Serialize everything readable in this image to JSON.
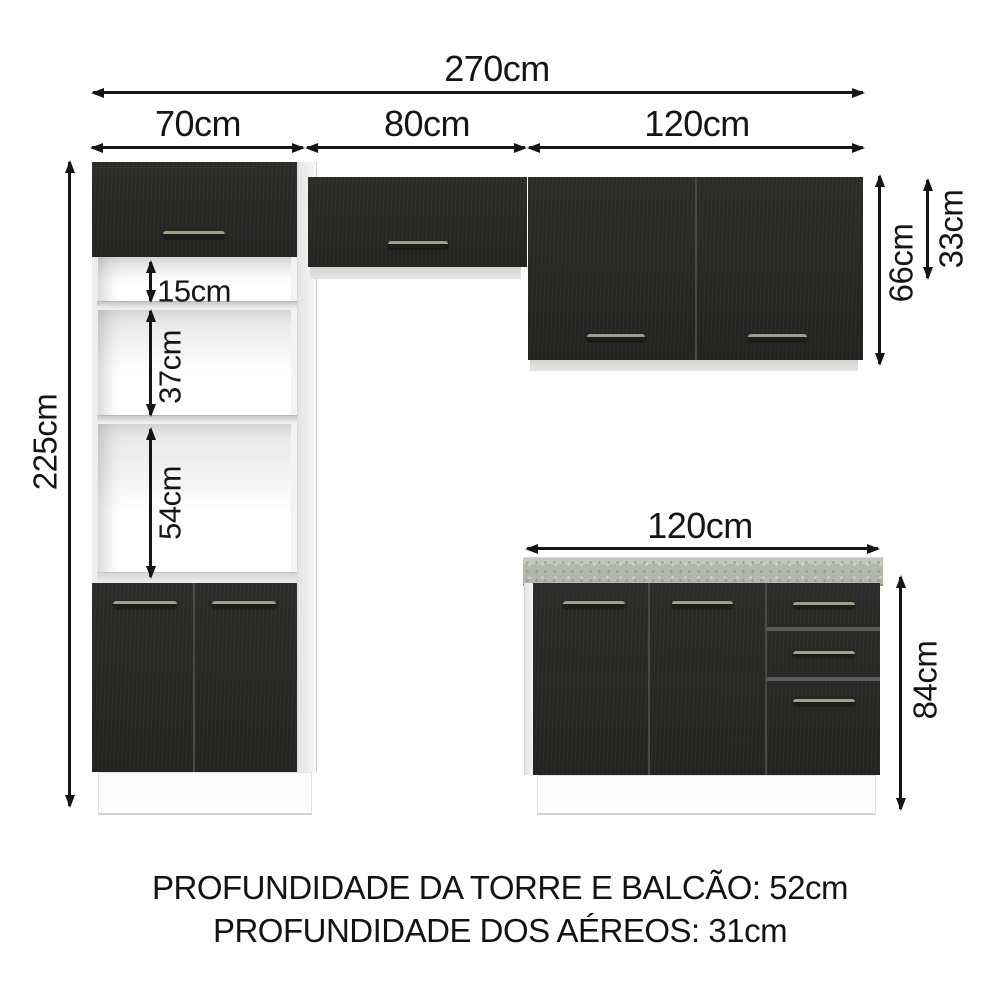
{
  "dimensions": {
    "total_width": "270cm",
    "tower_width": "70cm",
    "middle_width": "80cm",
    "aerial_right_width": "120cm",
    "tower_height": "225cm",
    "niche_top_height": "15cm",
    "niche_middle_height": "37cm",
    "niche_bottom_height": "54cm",
    "aerial_height": "66cm",
    "aerial_middle_height": "33cm",
    "counter_width": "120cm",
    "counter_height": "84cm"
  },
  "footer": {
    "line1": "PROFUNDIDADE DA TORRE E BALCÃO: 52cm",
    "line2": "PROFUNDIDADE DOS AÉREOS: 31cm"
  },
  "colors": {
    "cabinet_black": "#262624",
    "countertop_gray": "#b2b6ab",
    "handle_light": "#9fa089",
    "line_black": "#151515",
    "background": "#ffffff"
  }
}
